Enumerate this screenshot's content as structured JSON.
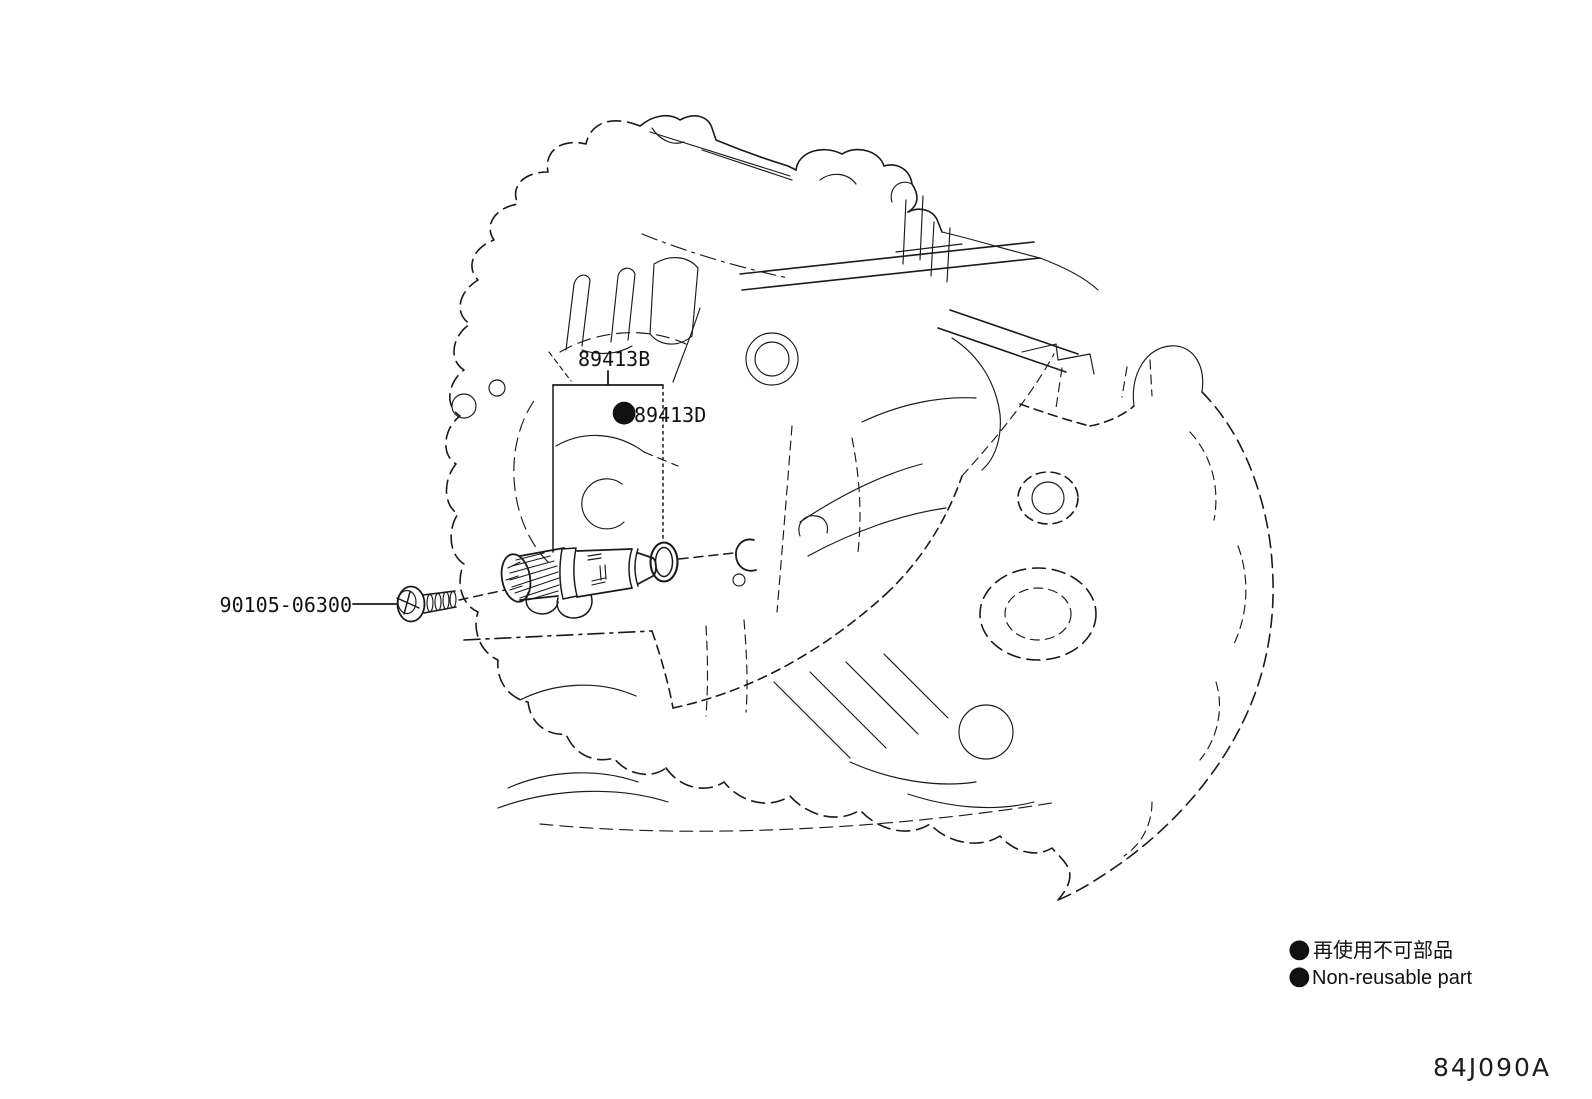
{
  "page": {
    "background": "#ffffff",
    "ink": "#1a1a1a"
  },
  "parts": {
    "sensor": {
      "part_no": "89413B"
    },
    "o_ring": {
      "marker": "●",
      "part_no": "89413D"
    },
    "bolt": {
      "part_no": "90105-06300"
    }
  },
  "legend": {
    "rows": [
      {
        "marker": "●",
        "text": "再使用不可部品"
      },
      {
        "marker": "●",
        "text": "Non-reusable part"
      }
    ]
  },
  "figure_code": "84J090A"
}
